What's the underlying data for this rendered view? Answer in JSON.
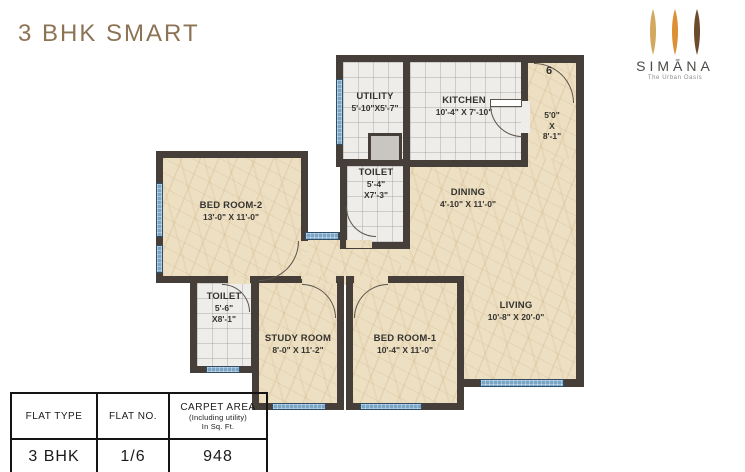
{
  "header": {
    "title": "3 BHK SMART"
  },
  "logo": {
    "brand": "SIMĀNA",
    "tagline": "The Urban Oasis",
    "petals": [
      "#d2a95e",
      "#dd8f33",
      "#6e4a2d"
    ]
  },
  "plan": {
    "unit_number": "6",
    "rooms": {
      "utility": {
        "name": "UTILITY",
        "dims": "5'-10\"X5'-7\""
      },
      "kitchen": {
        "name": "KITCHEN",
        "dims": "10'-4\" X 7'-10\""
      },
      "foyer": {
        "dim1": "5'0\"",
        "dim2": "X",
        "dim3": "8'-1\""
      },
      "toilet_top": {
        "name": "TOILET",
        "dim1": "5'-4\"",
        "dim2": "X7'-3\""
      },
      "dining": {
        "name": "DINING",
        "dims": "4'-10\" X 11'-0\""
      },
      "bedroom2": {
        "name": "BED ROOM-2",
        "dims": "13'-0\" X 11'-0\""
      },
      "toilet_low": {
        "name": "TOILET",
        "dim1": "5'-6\"",
        "dim2": "X8'-1\""
      },
      "study": {
        "name": "STUDY ROOM",
        "dims": "8'-0\" X 11'-2\""
      },
      "bedroom1": {
        "name": "BED ROOM-1",
        "dims": "10'-4\" X 11'-0\""
      },
      "living": {
        "name": "LIVING",
        "dims": "10'-8\" X 20'-0\""
      }
    }
  },
  "table": {
    "headers": {
      "flat_type": "FLAT TYPE",
      "flat_no": "FLAT NO.",
      "carpet_area": "CARPET AREA",
      "carpet_sub1": "(Including utility)",
      "carpet_sub2": "In Sq. Ft."
    },
    "values": {
      "flat_type": "3 BHK",
      "flat_no": "1/6",
      "carpet_area": "948"
    }
  },
  "colors": {
    "accent_brown": "#8d7355",
    "wall": "#463f39",
    "marble_floor": "#ecdfc2",
    "window_blue": "#79a5c7"
  }
}
